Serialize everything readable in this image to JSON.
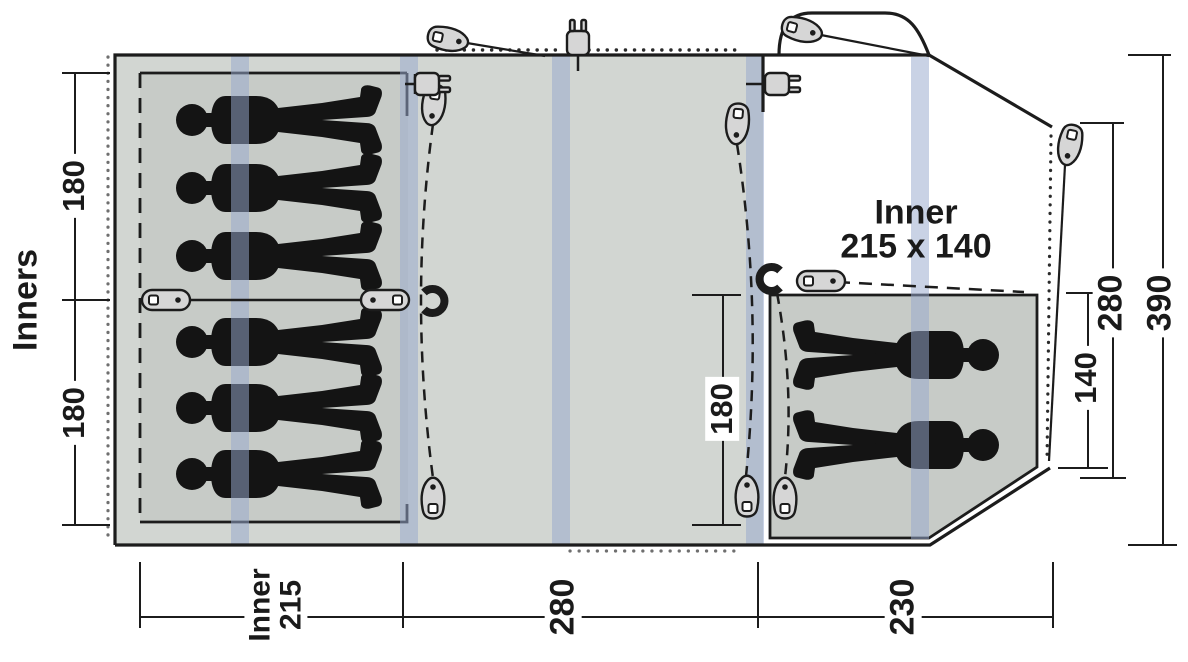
{
  "floorplan": {
    "side_label": "Inners",
    "right_inner_caption": {
      "title": "Inner",
      "size": "215 x 140"
    },
    "dims": {
      "left_inner_top": "180",
      "left_inner_bottom": "180",
      "living_door": "180",
      "right_inner_depth": "140",
      "rear_section_depth": "280",
      "total_depth": "390",
      "bottom_inner_word": "Inner",
      "bottom_inner_value": "215",
      "bottom_living_width": "280",
      "bottom_porch_width": "230"
    },
    "occupants": {
      "left_inner_sleepers": 6,
      "right_inner_sleepers": 2
    },
    "icons": {
      "peg": "guy-point-peg",
      "toggle": "tie-toggle",
      "magnet": "magnetic-curtain-clip",
      "plug": "power-inlet-plug"
    },
    "colors": {
      "floor": "#d2d6d2",
      "inner_floor": "#c7cbc7",
      "pole_band": "#97a8cd",
      "outline": "#1c1c1c",
      "silhouette": "#141414"
    }
  }
}
